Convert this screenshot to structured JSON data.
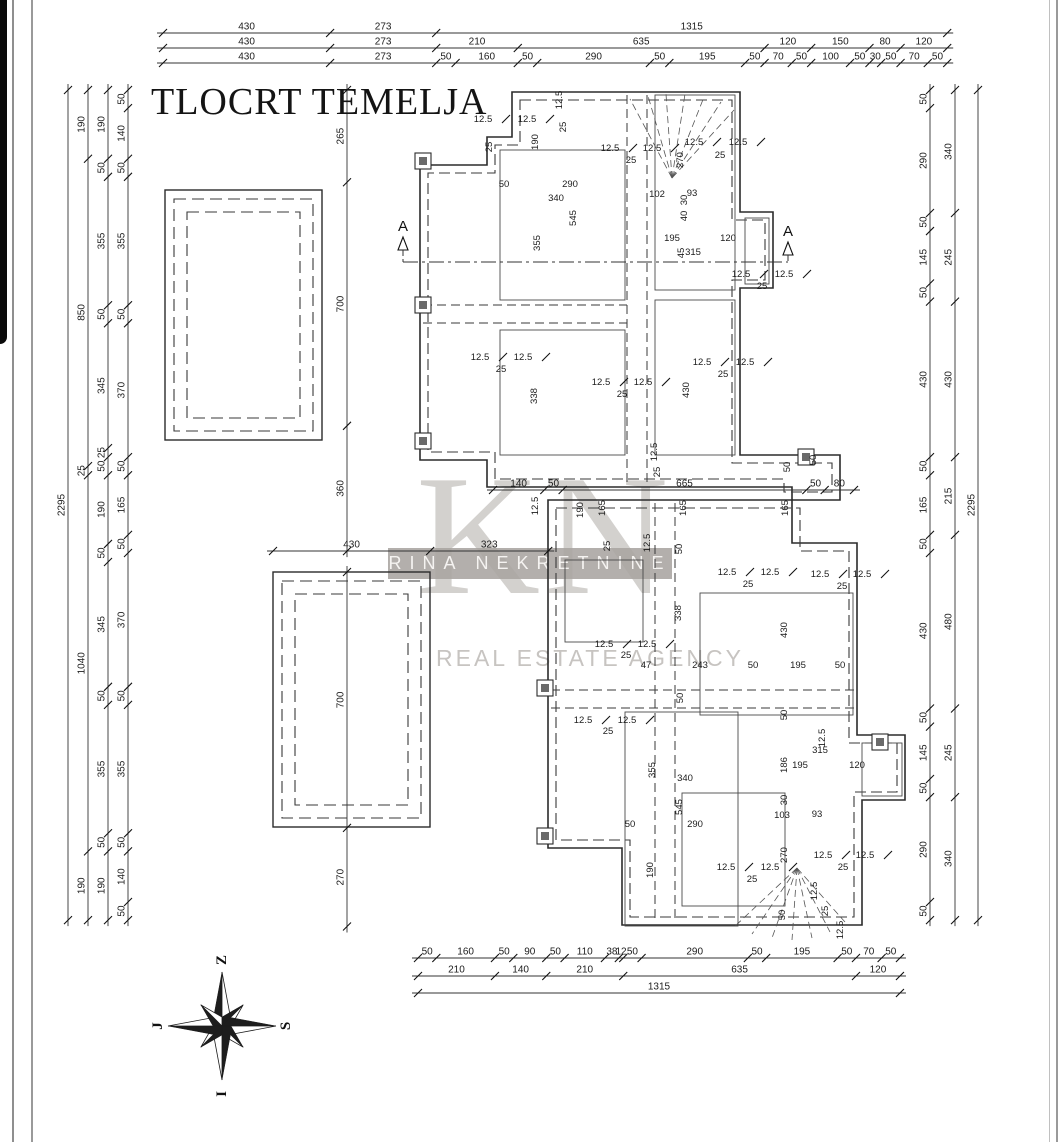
{
  "title": "TLOCRT TEMELJA",
  "watermark": {
    "monogram": "KN",
    "agency_name": "RINA NEKRETNINE",
    "tagline": "REAL ESTATE AGENCY"
  },
  "compass": {
    "top": "Z",
    "right": "S",
    "left": "J",
    "bottom": "I"
  },
  "section_marks": [
    {
      "x": 403,
      "y": 231,
      "label": "A"
    },
    {
      "x": 788,
      "y": 236,
      "label": "A"
    }
  ],
  "section_line": {
    "y": 262,
    "x1": 403,
    "x2": 788
  },
  "chains": [
    {
      "o": "h",
      "y": 33,
      "x0": 163,
      "s": 0.3886,
      "vals": [
        "430",
        "273",
        "1315"
      ]
    },
    {
      "o": "h",
      "y": 48,
      "x0": 163,
      "s": 0.3886,
      "vals": [
        "430",
        "273",
        "210",
        "635",
        "120",
        "150",
        "80",
        "120"
      ]
    },
    {
      "o": "h",
      "y": 63,
      "x0": 163,
      "s": 0.3886,
      "vals": [
        "430",
        "273",
        "50",
        "160",
        "50",
        "290",
        "50",
        "195",
        "50",
        "70",
        "50",
        "100",
        "50",
        "30",
        "50",
        "70",
        "50"
      ]
    },
    {
      "o": "h",
      "y": 958,
      "x0": 418,
      "s": 0.3665,
      "vals": [
        "50",
        "160",
        "50",
        "90",
        "50",
        "110",
        "38",
        "12",
        "50",
        "290",
        "50",
        "195",
        "50",
        "70",
        "50"
      ]
    },
    {
      "o": "h",
      "y": 976,
      "x0": 418,
      "s": 0.3665,
      "vals": [
        "210",
        "140",
        "210",
        "635",
        "120"
      ]
    },
    {
      "o": "h",
      "y": 993,
      "x0": 418,
      "s": 0.3665,
      "vals": [
        "1315"
      ]
    },
    {
      "o": "h",
      "y": 490,
      "x0": 493,
      "s": 0.3665,
      "vals": [
        "140",
        "50",
        "665",
        "50",
        "80"
      ]
    },
    {
      "o": "h",
      "y": 551,
      "x0": 273,
      "s": 0.3655,
      "vals": [
        "430",
        "323"
      ]
    },
    {
      "o": "v",
      "x": 68,
      "y0": 90,
      "s": 0.3617,
      "vals": [
        "2295"
      ]
    },
    {
      "o": "v",
      "x": 88,
      "y0": 90,
      "s": 0.3617,
      "vals": [
        "190",
        "850",
        "25",
        "1040",
        "190"
      ]
    },
    {
      "o": "v",
      "x": 108,
      "y0": 90,
      "s": 0.3617,
      "vals": [
        "190",
        "50",
        "355",
        "50",
        "345",
        "25",
        "50",
        "190",
        "50",
        "345",
        "50",
        "355",
        "50",
        "190"
      ]
    },
    {
      "o": "v",
      "x": 128,
      "y0": 90,
      "s": 0.3617,
      "vals": [
        "50",
        "140",
        "50",
        "355",
        "50",
        "370",
        "50",
        "165",
        "50",
        "370",
        "50",
        "355",
        "50",
        "140",
        "50"
      ]
    },
    {
      "o": "v",
      "x": 930,
      "y0": 90,
      "s": 0.3617,
      "vals": [
        "50",
        "290",
        "50",
        "145",
        "50",
        "430",
        "50",
        "165",
        "50",
        "430",
        "50",
        "145",
        "50",
        "290",
        "50"
      ]
    },
    {
      "o": "v",
      "x": 955,
      "y0": 90,
      "s": 0.3617,
      "vals": [
        "340",
        "245",
        "430",
        "215",
        "480",
        "245",
        "340"
      ]
    },
    {
      "o": "v",
      "x": 978,
      "y0": 90,
      "s": 0.3617,
      "vals": [
        "2295"
      ]
    },
    {
      "o": "v",
      "x": 347,
      "y0": 90,
      "s": 0.348,
      "vals": [
        "265",
        "700",
        "360"
      ]
    },
    {
      "o": "v",
      "x": 347,
      "y0": 572,
      "s": 0.3655,
      "vals": [
        "700",
        "270"
      ]
    }
  ],
  "labels": [
    [
      562,
      100,
      "12.5",
      1
    ],
    [
      566,
      127,
      "25",
      1
    ],
    [
      483,
      122,
      "12.5"
    ],
    [
      527,
      122,
      "12.5"
    ],
    [
      492,
      147,
      "25",
      1
    ],
    [
      538,
      142,
      "190",
      1
    ],
    [
      504,
      187,
      "50"
    ],
    [
      570,
      187,
      "290"
    ],
    [
      556,
      201,
      "340"
    ],
    [
      576,
      218,
      "545",
      1
    ],
    [
      540,
      243,
      "355",
      1
    ],
    [
      610,
      151,
      "12.5"
    ],
    [
      652,
      151,
      "12.5"
    ],
    [
      631,
      163,
      "25"
    ],
    [
      694,
      145,
      "12.5"
    ],
    [
      738,
      145,
      "12.5"
    ],
    [
      720,
      158,
      "25"
    ],
    [
      657,
      197,
      "102"
    ],
    [
      692,
      196,
      "93"
    ],
    [
      683,
      160,
      "270",
      1
    ],
    [
      687,
      200,
      "30",
      1
    ],
    [
      687,
      216,
      "40",
      1
    ],
    [
      672,
      241,
      "195"
    ],
    [
      728,
      241,
      "120"
    ],
    [
      693,
      255,
      "315"
    ],
    [
      684,
      253,
      "45",
      1
    ],
    [
      741,
      277,
      "12.5"
    ],
    [
      784,
      277,
      "12.5"
    ],
    [
      762,
      289,
      "25"
    ],
    [
      480,
      360,
      "12.5"
    ],
    [
      523,
      360,
      "12.5"
    ],
    [
      501,
      372,
      "25"
    ],
    [
      537,
      396,
      "338",
      1
    ],
    [
      601,
      385,
      "12.5"
    ],
    [
      643,
      385,
      "12.5"
    ],
    [
      622,
      397,
      "25"
    ],
    [
      702,
      365,
      "12.5"
    ],
    [
      745,
      365,
      "12.5"
    ],
    [
      723,
      377,
      "25"
    ],
    [
      689,
      390,
      "430",
      1
    ],
    [
      657,
      452,
      "12.5",
      1
    ],
    [
      660,
      472,
      "25",
      1
    ],
    [
      790,
      467,
      "50",
      1
    ],
    [
      816,
      460,
      "50",
      1
    ],
    [
      538,
      506,
      "12.5",
      1
    ],
    [
      650,
      543,
      "12.5",
      1
    ],
    [
      583,
      510,
      "190",
      1
    ],
    [
      605,
      508,
      "165",
      1
    ],
    [
      686,
      508,
      "165",
      1
    ],
    [
      788,
      508,
      "165",
      1
    ],
    [
      610,
      546,
      "25",
      1
    ],
    [
      682,
      549,
      "50",
      1
    ],
    [
      727,
      575,
      "12.5"
    ],
    [
      770,
      575,
      "12.5"
    ],
    [
      748,
      587,
      "25"
    ],
    [
      820,
      577,
      "12.5"
    ],
    [
      862,
      577,
      "12.5"
    ],
    [
      842,
      589,
      "25"
    ],
    [
      604,
      647,
      "12.5"
    ],
    [
      647,
      647,
      "12.5"
    ],
    [
      626,
      658,
      "25"
    ],
    [
      681,
      613,
      "338",
      1
    ],
    [
      787,
      630,
      "430",
      1
    ],
    [
      646,
      668,
      "47"
    ],
    [
      700,
      668,
      "243"
    ],
    [
      753,
      668,
      "50"
    ],
    [
      798,
      668,
      "195"
    ],
    [
      840,
      668,
      "50"
    ],
    [
      683,
      698,
      "50",
      1
    ],
    [
      583,
      723,
      "12.5"
    ],
    [
      627,
      723,
      "12.5"
    ],
    [
      608,
      734,
      "25"
    ],
    [
      655,
      770,
      "355",
      1
    ],
    [
      685,
      781,
      "340"
    ],
    [
      682,
      807,
      "545",
      1
    ],
    [
      630,
      827,
      "50"
    ],
    [
      695,
      827,
      "290"
    ],
    [
      653,
      870,
      "190",
      1
    ],
    [
      787,
      715,
      "50",
      1
    ],
    [
      825,
      738,
      "12.5",
      1
    ],
    [
      820,
      753,
      "315"
    ],
    [
      787,
      765,
      "186",
      1
    ],
    [
      800,
      768,
      "195"
    ],
    [
      857,
      768,
      "120"
    ],
    [
      787,
      800,
      "30",
      1
    ],
    [
      782,
      818,
      "103"
    ],
    [
      817,
      817,
      "93"
    ],
    [
      787,
      855,
      "270",
      1
    ],
    [
      823,
      858,
      "12.5"
    ],
    [
      865,
      858,
      "12.5"
    ],
    [
      843,
      870,
      "25"
    ],
    [
      726,
      870,
      "12.5"
    ],
    [
      770,
      870,
      "12.5"
    ],
    [
      752,
      882,
      "25"
    ],
    [
      817,
      891,
      "12.5",
      1
    ],
    [
      828,
      911,
      "25",
      1
    ],
    [
      785,
      915,
      "50",
      1
    ],
    [
      843,
      930,
      "12.5",
      1
    ]
  ],
  "plan": {
    "outer_paths": [
      "M512,92 H740 V212 H773 V288 H740 V455 H840 V500 H792 V487 H487 V460 H420 V165 H487 V137 H512 Z",
      "M548,500 H792 V543 H857 V735 H905 V800 H862 V925 H622 V848 H548 Z"
    ],
    "inner_dashed_paths": [
      "M520,100 H732 V220 H765 V280 H732 V463 H832 V492 H784 V479 H495 V452 H428 V173 H495 V145 H520 Z",
      "M556,508 H800 V551 H849 V743 H897 V792 H854 V917 H630 V840 H556 Z"
    ],
    "detached_rects": [
      {
        "x": 165,
        "y": 190,
        "w": 157,
        "h": 250
      },
      {
        "x": 273,
        "y": 572,
        "w": 157,
        "h": 255
      }
    ],
    "interior_dashed_lines": [
      [
        627,
        95,
        627,
        485
      ],
      [
        647,
        95,
        647,
        485
      ],
      [
        423,
        305,
        627,
        305
      ],
      [
        423,
        323,
        627,
        323
      ],
      [
        655,
        503,
        655,
        922
      ],
      [
        675,
        503,
        675,
        922
      ],
      [
        551,
        690,
        855,
        690
      ],
      [
        551,
        708,
        855,
        708
      ]
    ],
    "rooms": [
      {
        "x": 500,
        "y": 150,
        "w": 125,
        "h": 150
      },
      {
        "x": 500,
        "y": 330,
        "w": 125,
        "h": 125
      },
      {
        "x": 655,
        "y": 95,
        "w": 80,
        "h": 195
      },
      {
        "x": 655,
        "y": 300,
        "w": 80,
        "h": 155
      },
      {
        "x": 745,
        "y": 218,
        "w": 24,
        "h": 66
      },
      {
        "x": 565,
        "y": 560,
        "w": 78,
        "h": 82
      },
      {
        "x": 700,
        "y": 593,
        "w": 153,
        "h": 122
      },
      {
        "x": 625,
        "y": 712,
        "w": 113,
        "h": 214
      },
      {
        "x": 682,
        "y": 793,
        "w": 103,
        "h": 113
      },
      {
        "x": 862,
        "y": 743,
        "w": 40,
        "h": 53
      }
    ],
    "columns": [
      [
        423,
        161
      ],
      [
        423,
        305
      ],
      [
        423,
        441
      ],
      [
        806,
        457
      ],
      [
        545,
        688
      ],
      [
        545,
        836
      ],
      [
        880,
        742
      ]
    ],
    "fans": [
      {
        "cx": 672,
        "cy": 178,
        "rays": [
          [
            630,
            99
          ],
          [
            648,
            96
          ],
          [
            666,
            94
          ],
          [
            685,
            94
          ],
          [
            704,
            97
          ],
          [
            721,
            102
          ],
          [
            734,
            110
          ]
        ]
      },
      {
        "cx": 797,
        "cy": 868,
        "rays": [
          [
            733,
            928
          ],
          [
            752,
            934
          ],
          [
            772,
            938
          ],
          [
            792,
            940
          ],
          [
            812,
            938
          ],
          [
            830,
            932
          ],
          [
            845,
            922
          ]
        ]
      }
    ]
  }
}
